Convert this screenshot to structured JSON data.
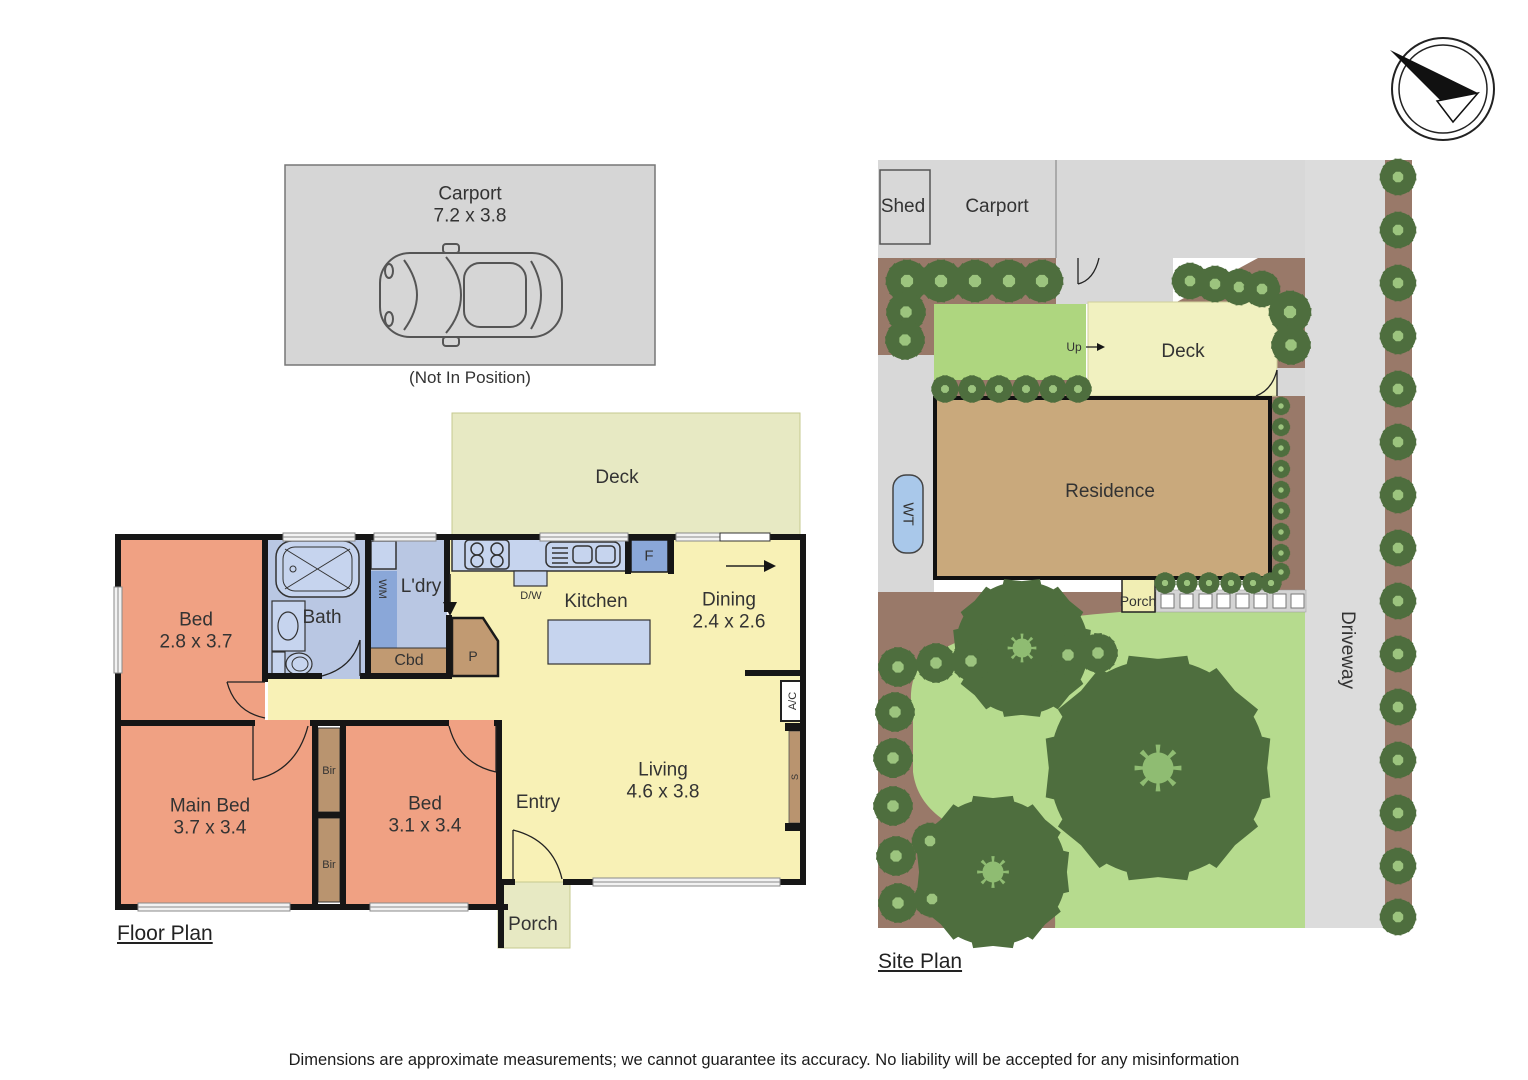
{
  "carport_diagram": {
    "label": "Carport",
    "size": "7.2 x 3.8",
    "note": "(Not In Position)"
  },
  "floor_plan": {
    "title": "Floor Plan",
    "deck": "Deck",
    "bed1": {
      "name": "Bed",
      "size": "2.8 x 3.7"
    },
    "bath": "Bath",
    "laundry": "L'dry",
    "washing_machine": "WM",
    "dishwasher": "D/W",
    "kitchen": "Kitchen",
    "fridge": "F",
    "dining": {
      "name": "Dining",
      "size": "2.4 x 2.6"
    },
    "cupboard": "Cbd",
    "pantry": "P",
    "air_con": "A/C",
    "store": "S",
    "living": {
      "name": "Living",
      "size": "4.6 x 3.8"
    },
    "entry": "Entry",
    "main_bed": {
      "name": "Main Bed",
      "size": "3.7 x 3.4"
    },
    "bed2": {
      "name": "Bed",
      "size": "3.1 x 3.4"
    },
    "bir_top": "Bir",
    "bir_bottom": "Bir",
    "porch": "Porch"
  },
  "site_plan": {
    "title": "Site Plan",
    "shed": "Shed",
    "carport": "Carport",
    "up": "Up",
    "deck": "Deck",
    "residence": "Residence",
    "water_tank": "WT",
    "porch": "Porch",
    "driveway": "Driveway"
  },
  "footer": {
    "disclaimer": "Dimensions are approximate measurements; we cannot guarantee its accuracy. No liability will be accepted for any misinformation"
  },
  "colors": {
    "bedroom": "#F0A183",
    "wet_area": "#B9C7E3",
    "appliance_blue": "#8AA7D8",
    "living_area": "#F8F1B6",
    "deck": "#E7E9C3",
    "joinery_brown": "#C19A72",
    "wall": "#161616",
    "site_lawn": "#B6DB8E",
    "site_garden_bed": "#997969",
    "site_tree": "#8FBC72",
    "site_paving": "#D8D8D8",
    "site_residence": "#C9A97C",
    "site_deck": "#F1F1C0",
    "water_tank_blue": "#A9C8EA"
  }
}
